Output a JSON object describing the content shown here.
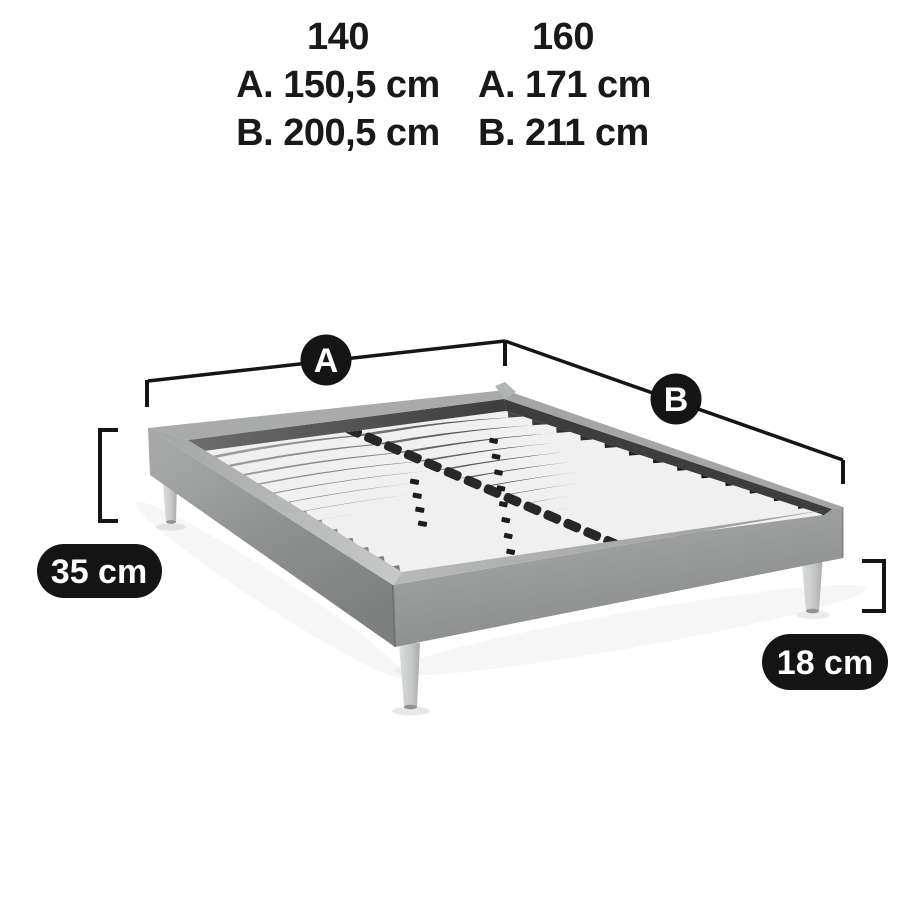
{
  "size_table": {
    "columns": [
      {
        "width_header": "140",
        "dim_a": "A. 150,5 cm",
        "dim_b": "B. 200,5 cm"
      },
      {
        "width_header": "160",
        "dim_a": "A. 171 cm",
        "dim_b": "B. 211 cm"
      }
    ]
  },
  "markers": {
    "width_marker": "A",
    "length_marker": "B"
  },
  "badges": {
    "total_height": "35 cm",
    "leg_height": "18 cm"
  },
  "colors": {
    "annotation_black": "#151515",
    "badge_text": "#ffffff",
    "frame_fabric": "#9a9c9c",
    "slats": "#f0f0f0",
    "legs": "#d2d4d4",
    "background": "#ffffff"
  }
}
